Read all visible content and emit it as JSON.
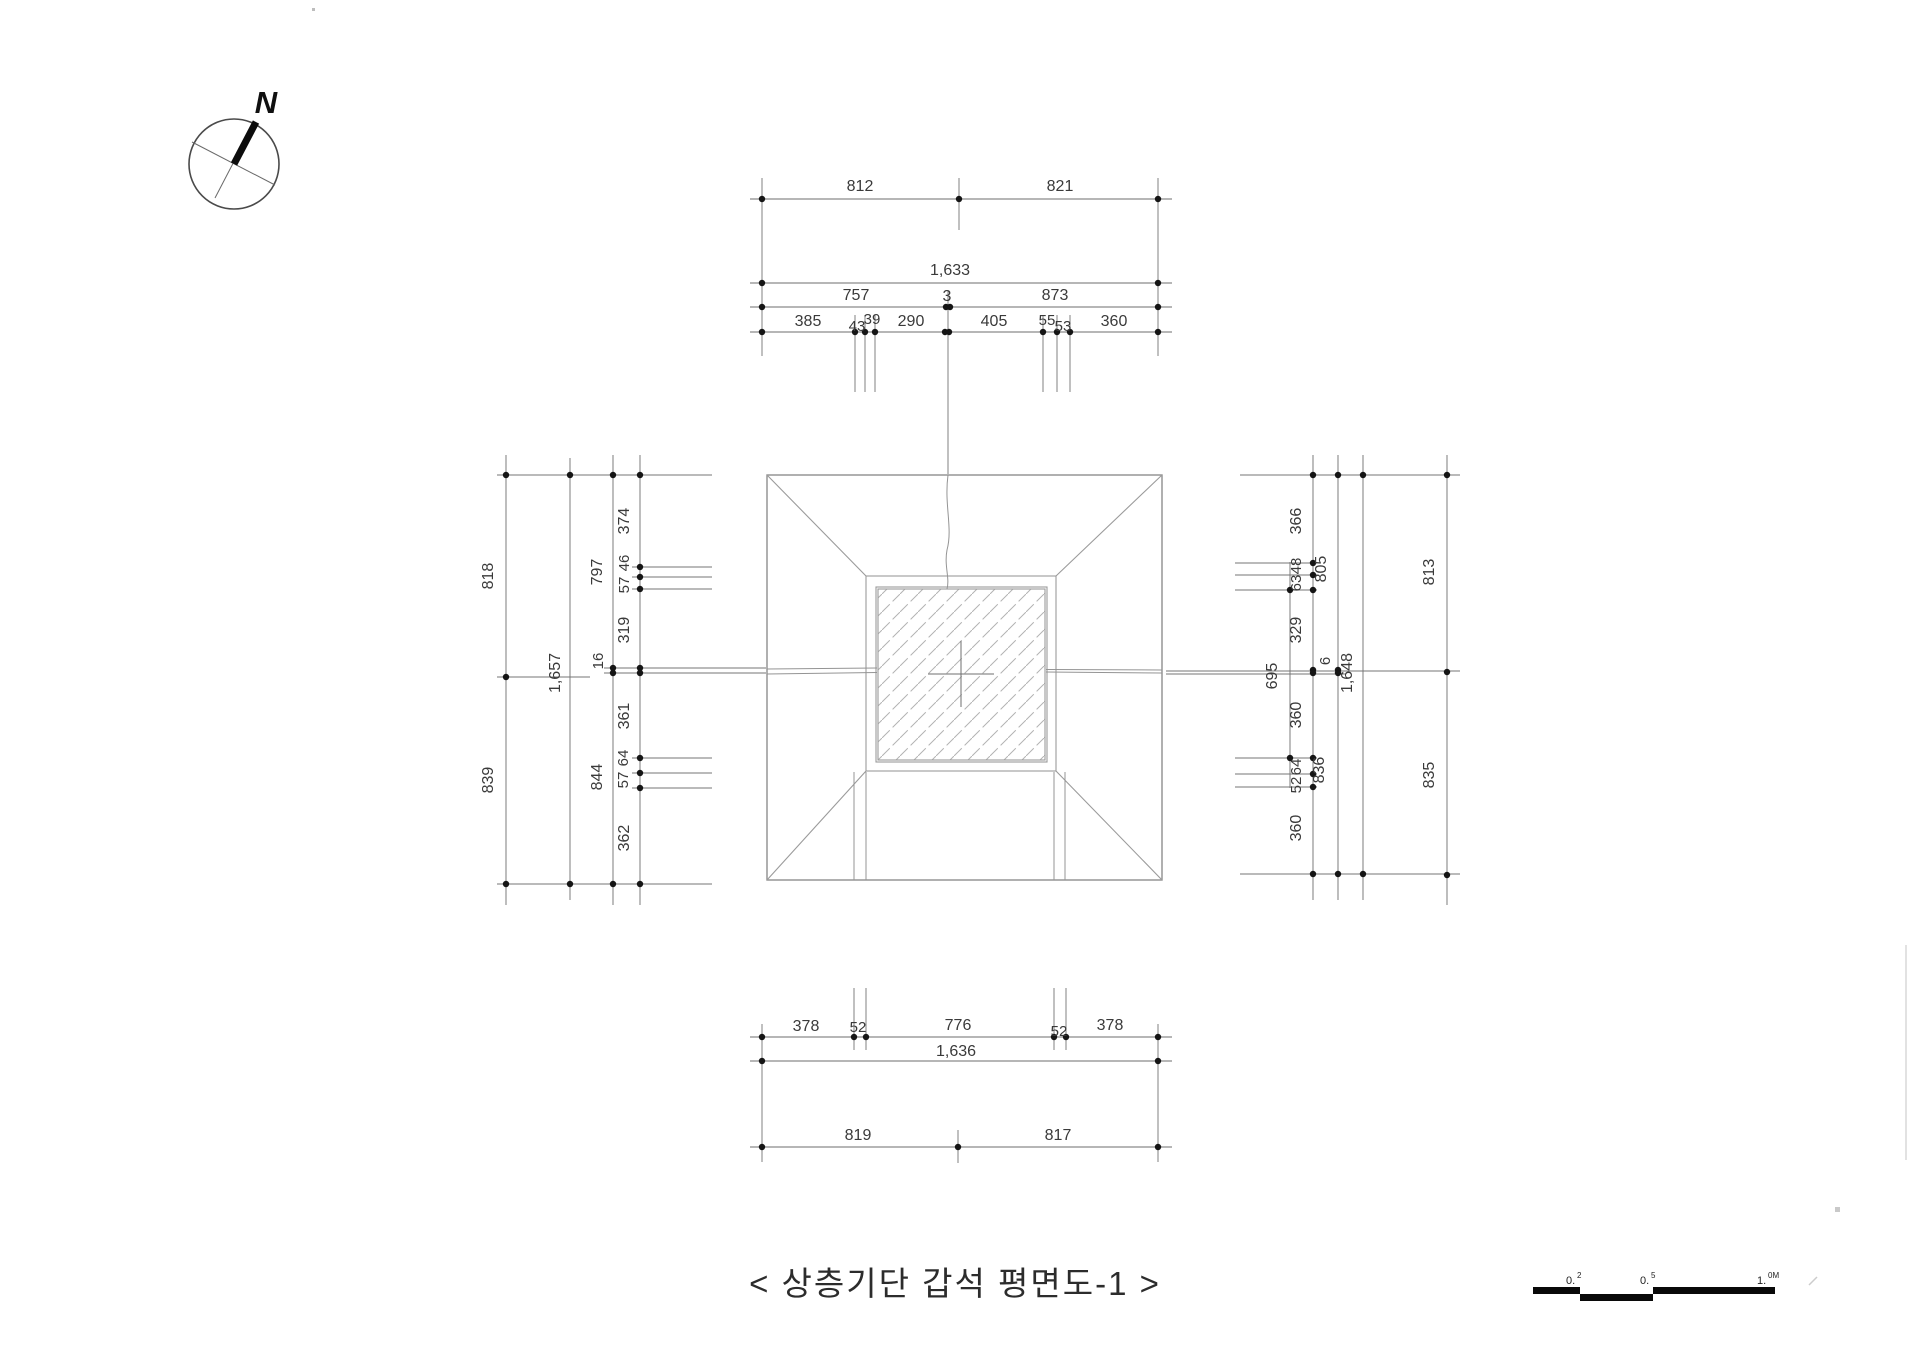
{
  "title": {
    "text": "< 상층기단 갑석 평면도-1 >"
  },
  "compass": {
    "north": "N"
  },
  "dims": {
    "top": {
      "halves": [
        "812",
        "821"
      ],
      "total": "1,633",
      "thirds": [
        "757",
        "3",
        "873"
      ],
      "detail": [
        "385",
        "43",
        "39",
        "290",
        "405",
        "55",
        "53",
        "360"
      ]
    },
    "bottom": {
      "detail": [
        "378",
        "52",
        "776",
        "52",
        "378"
      ],
      "total": "1,636",
      "halves": [
        "819",
        "817"
      ]
    },
    "left": {
      "halves": [
        "818",
        "839"
      ],
      "total": "1,657",
      "thirds": [
        "797",
        "16",
        "844"
      ],
      "detail": [
        "374",
        "46",
        "57",
        "319",
        "361",
        "64",
        "57",
        "362"
      ]
    },
    "right": {
      "halves": [
        "813",
        "835"
      ],
      "total": "1,648",
      "thirds": [
        "805",
        "6",
        "836"
      ],
      "detail": [
        "366",
        "48",
        "63",
        "329",
        "360",
        "64",
        "52",
        "360"
      ],
      "span": "695"
    }
  },
  "scale": {
    "labels": [
      {
        "main": "0.",
        "sup": "2"
      },
      {
        "main": "0.",
        "sup": "5"
      },
      {
        "main": "1.",
        "sup": "0M"
      }
    ]
  }
}
